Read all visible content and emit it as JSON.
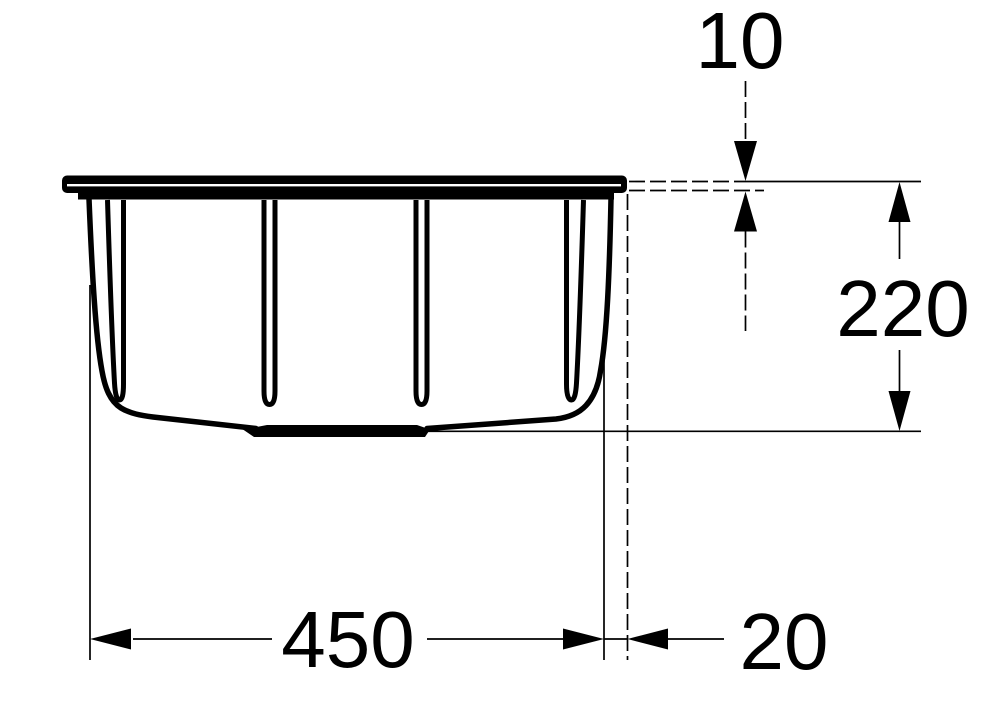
{
  "figure": {
    "kind": "dimensioned technical drawing",
    "subject": "sink bowl cross-section, front elevation",
    "background_color": "#ffffff",
    "line_color": "#000000"
  },
  "dimensions": {
    "rim_thickness": {
      "label": "10"
    },
    "depth": {
      "label": "220"
    },
    "width": {
      "label": "450"
    },
    "rim_overhang": {
      "label": "20"
    }
  }
}
